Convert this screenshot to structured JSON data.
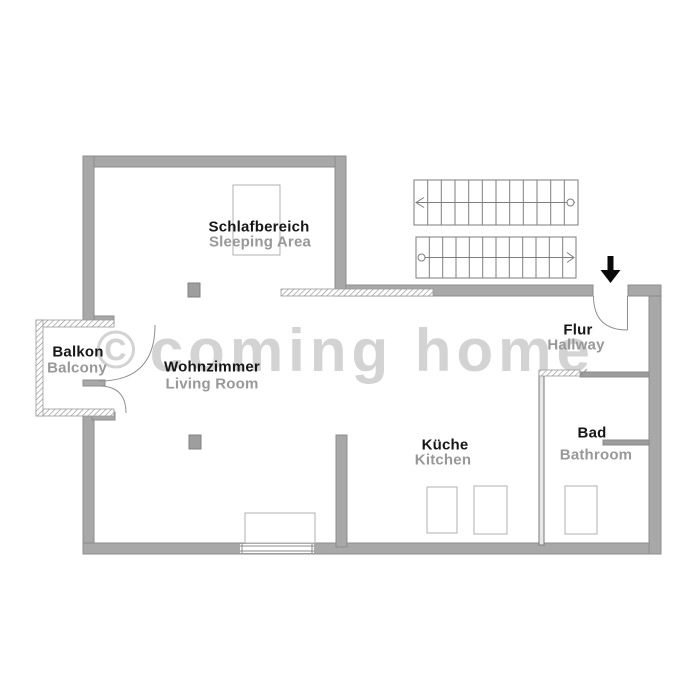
{
  "plan": {
    "rooms": [
      {
        "name_de": "Schlafbereich",
        "name_en": "Sleeping Area"
      },
      {
        "name_de": "Wohnzimmer",
        "name_en": "Living Room"
      },
      {
        "name_de": "Balkon",
        "name_en": "Balcony"
      },
      {
        "name_de": "Flur",
        "name_en": "Hallway"
      },
      {
        "name_de": "Küche",
        "name_en": "Kitchen"
      },
      {
        "name_de": "Bad",
        "name_en": "Bathroom"
      }
    ]
  },
  "watermark": {
    "symbol": "©",
    "text": "coming home"
  },
  "colors": {
    "floor": "#ffffff",
    "wall": "#a8a8a8",
    "wall_outline": "#8d8d8d",
    "label_primary": "#161616",
    "label_secondary": "#989898",
    "watermark": "#d3d3d3",
    "entrance_arrow": "#0a0a0a"
  }
}
